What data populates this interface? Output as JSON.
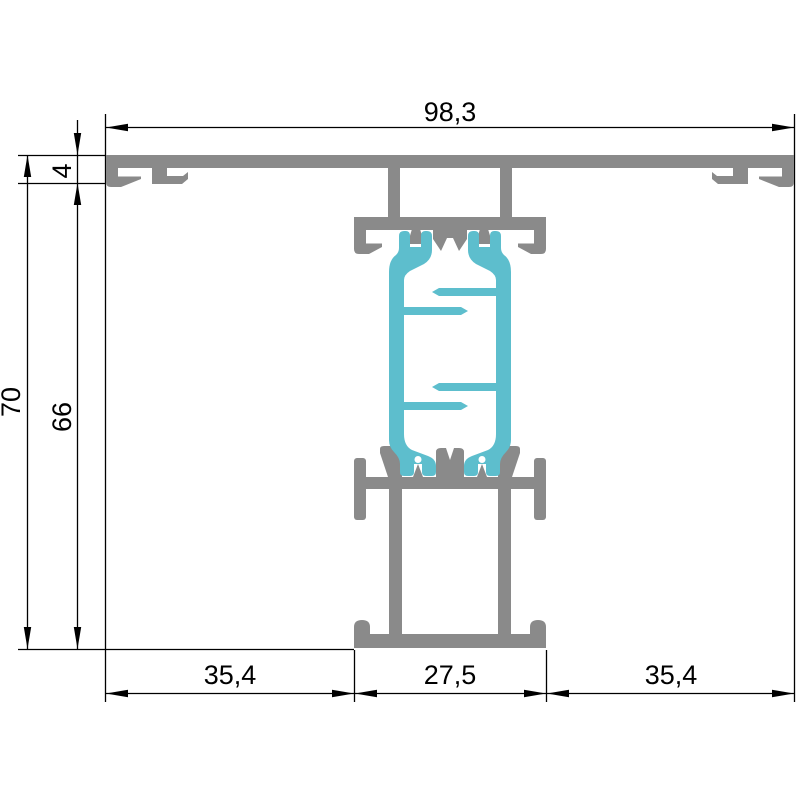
{
  "drawing": {
    "dimensions": {
      "total_width": "98,3",
      "top_flange_height": "4",
      "overall_height": "70",
      "body_height": "66",
      "bottom_left_width": "35,4",
      "bottom_center_width": "27,5",
      "bottom_right_width": "35,4"
    },
    "colors": {
      "aluminum": "#8a8a8a",
      "thermal_break": "#5dbecd",
      "lines": "#000000",
      "background": "#ffffff"
    }
  }
}
